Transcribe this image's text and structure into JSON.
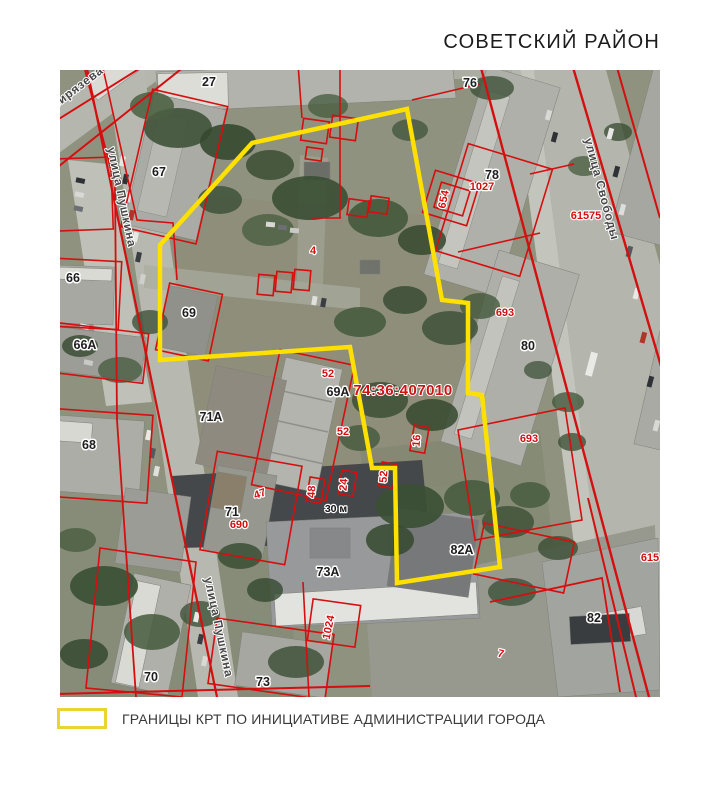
{
  "title": "СОВЕТСКИЙ РАЙОН",
  "legend": {
    "label": "ГРАНИЦЫ КРТ ПО ИНИЦИАТИВЕ АДМИНИСТРАЦИИ ГОРОДА",
    "swatch_color": "#ffe000"
  },
  "map": {
    "cadastral_quarter_label": "74:36:407010",
    "distance_label": "30 м",
    "streets": {
      "timiryazeva": "мирязева",
      "pushkina_upper": "улица Пушкина",
      "pushkina_lower": "улица Пушкина",
      "svobody": "улица Свободы"
    },
    "buildings": {
      "b27": "27",
      "b76": "76",
      "b67": "67",
      "b78": "78",
      "b66": "66",
      "b69": "69",
      "b66a": "66А",
      "b80": "80",
      "b71a": "71А",
      "b68": "68",
      "b69a": "69А",
      "b71": "71",
      "b73a": "73А",
      "b82a": "82А",
      "b82": "82",
      "b70": "70",
      "b73": "73"
    },
    "parcels": {
      "p1027": "1027",
      "p654": "654",
      "p61575": "61575",
      "p693_n": "693",
      "p4": "4",
      "p52_a": "52",
      "p693_s": "693",
      "p16": "16",
      "p52_b": "52",
      "p47": "47",
      "p48": "48",
      "p24": "24",
      "p52_c": "52",
      "p690": "690",
      "p615": "615",
      "p1024": "1024",
      "p7": "7"
    },
    "colors": {
      "boundary": "#ffe000",
      "cadastral": "#d40f0f"
    }
  }
}
